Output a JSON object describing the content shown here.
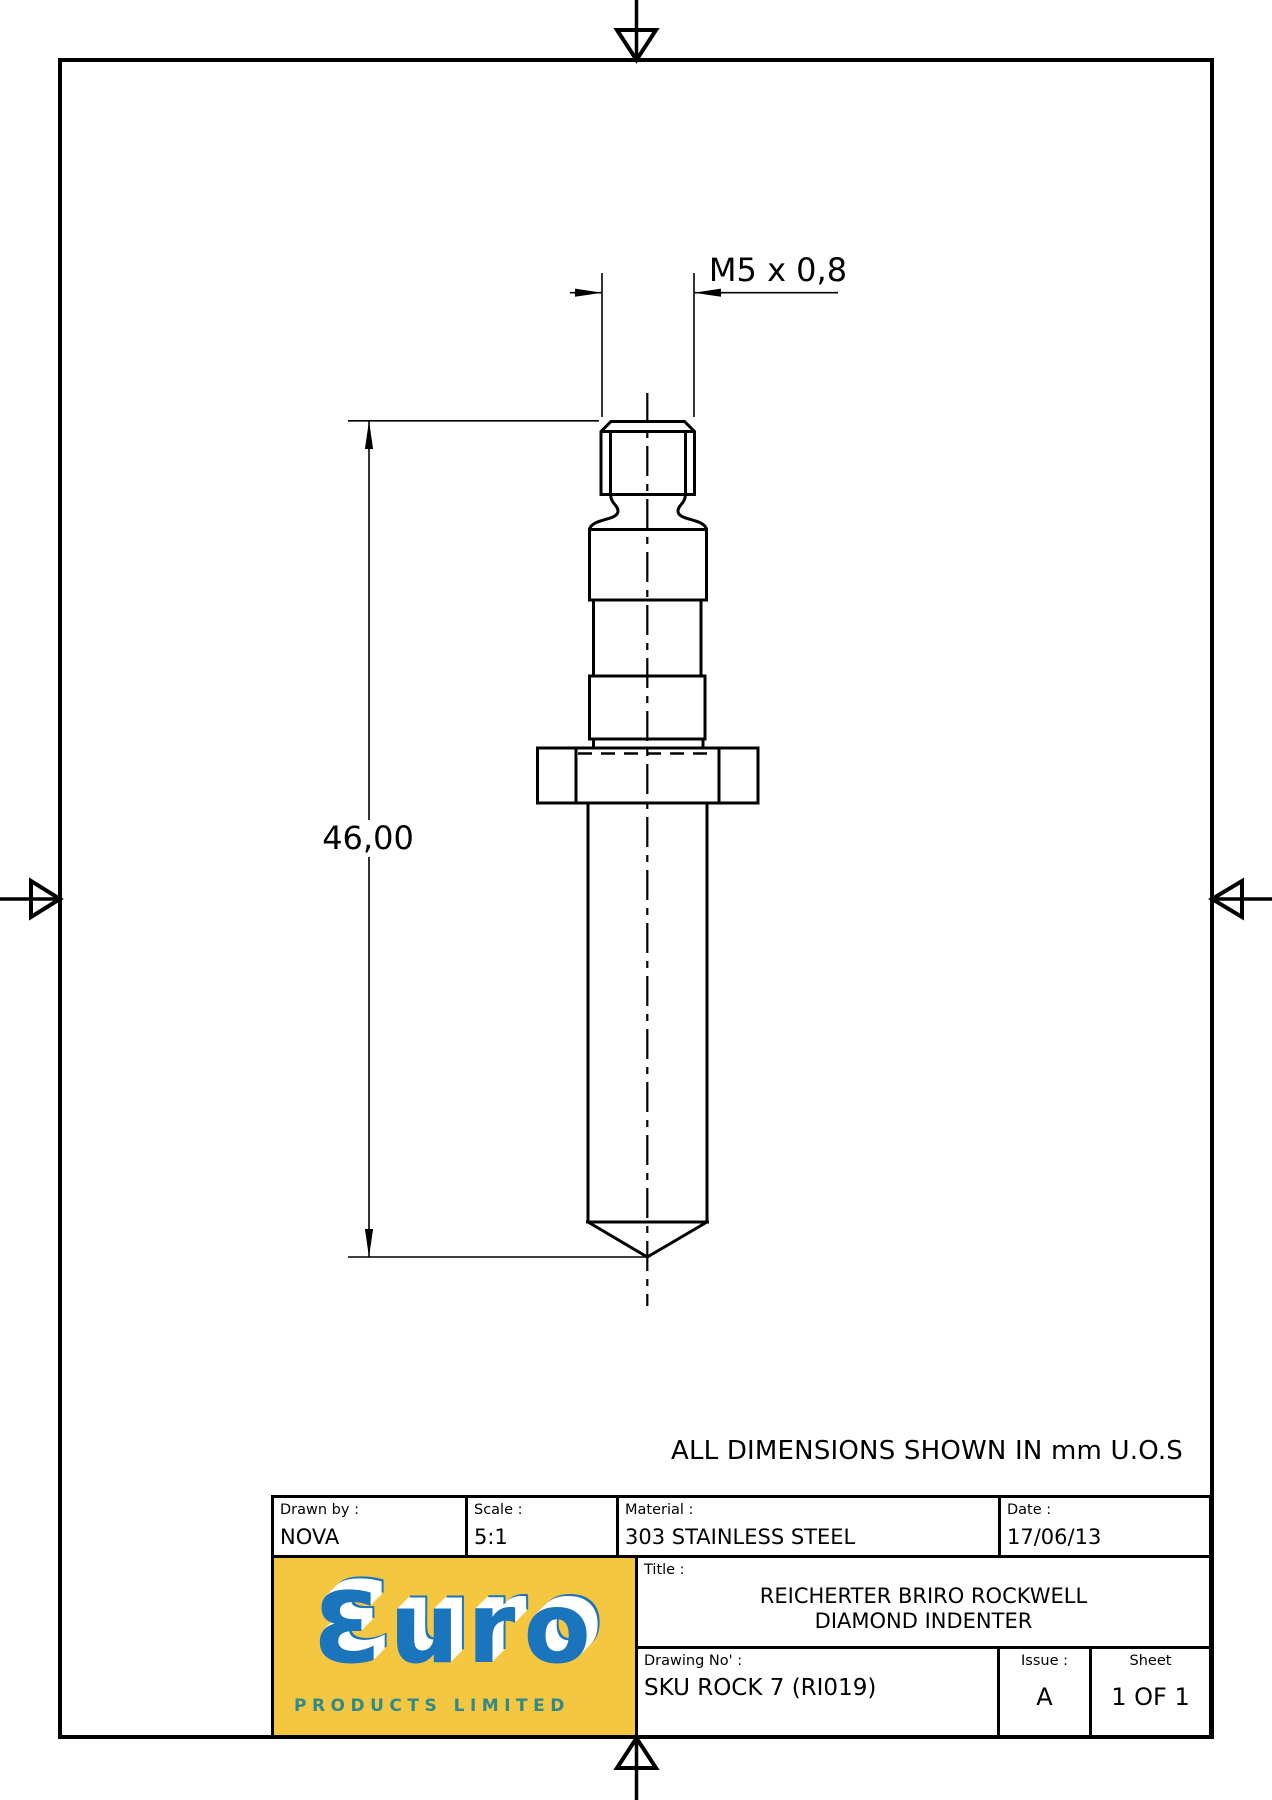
{
  "page": {
    "note": "ALL DIMENSIONS SHOWN IN mm U.O.S"
  },
  "drawing": {
    "part": "diamond indenter side view",
    "dimensions": {
      "thread_label": "M5 x 0,8",
      "overall_length_label": "46,00"
    }
  },
  "title_block": {
    "drawn_by": {
      "label": "Drawn by :",
      "value": "NOVA"
    },
    "scale": {
      "label": "Scale :",
      "value": "5:1"
    },
    "material": {
      "label": "Material :",
      "value": "303 STAINLESS STEEL"
    },
    "date": {
      "label": "Date :",
      "value": "17/06/13"
    },
    "title": {
      "label": "Title :",
      "line1": "REICHERTER BRIRO ROCKWELL",
      "line2": "DIAMOND INDENTER"
    },
    "drawing_no": {
      "label": "Drawing No' :",
      "value": "SKU ROCK 7 (RI019)"
    },
    "issue": {
      "label": "Issue :",
      "value": "A"
    },
    "sheet": {
      "label": "Sheet",
      "value": "1 OF 1"
    }
  },
  "logo": {
    "wordmark": "Ɛuro",
    "tagline": "PRODUCTS LIMITED",
    "colors": {
      "background": "#F5C63F",
      "letters": "#1B75BC",
      "tagline": "#2E8A8D"
    }
  }
}
